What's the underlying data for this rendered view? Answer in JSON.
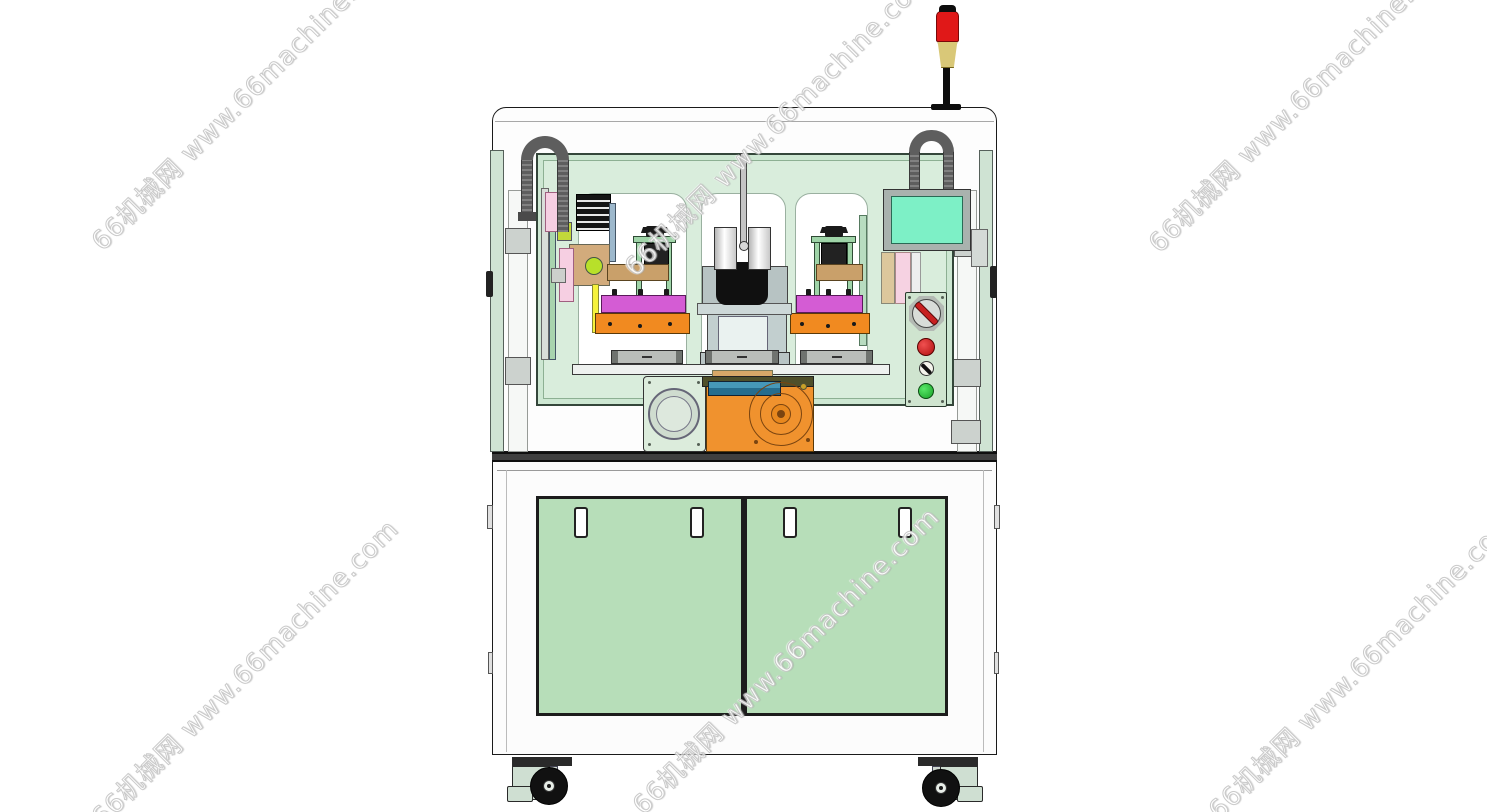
{
  "page": {
    "type": "product-image",
    "description": "CAD front view of a dual-station automatic assembly / screw-locking machine with safety enclosure, monitor, control panel, rotary indexer and caster base",
    "background_color": "#ffffff"
  },
  "watermark": {
    "text": "66机械网 www.66machine.com",
    "repeat_count": 6,
    "rotation_deg": -45,
    "text_color": "#ffffff",
    "outline_color": "#c6c6c6"
  },
  "machine": {
    "components": [
      "signal-tower",
      "safety-enclosure-window",
      "cable-drag-chain-left",
      "cable-drag-chain-right",
      "touch-monitor",
      "control-panel",
      "rotary-switch",
      "emergency-stop-button",
      "key-switch",
      "start-button",
      "left-fixture-station",
      "right-fixture-station",
      "center-press-unit",
      "motor-plate",
      "rotary-indexer-gearbox",
      "cabinet-door-left",
      "cabinet-door-right",
      "door-handles",
      "leveling-caster-left",
      "leveling-caster-right"
    ],
    "colors": {
      "enclosure_white": "#fcfcfc",
      "glass_green": "#cde7d2",
      "panel_green": "#d9eddc",
      "door_green": "#b7deb9",
      "control_panel_green": "#cfe4cf",
      "screen_mint": "#7df0c6",
      "base_orange": "#f0922e",
      "fixture_magenta": "#d45cd4",
      "clamp_tan": "#c9a06a",
      "plate_pink": "#f6d2e2",
      "accent_yellow_green": "#b8e02a",
      "signal_red": "#e01818",
      "signal_yellow": "#d9c878",
      "gearbox_blue": "#2e7d9e",
      "estop_red": "#c82020",
      "start_green": "#22c23a",
      "chain_gray": "#5e5e5e"
    }
  }
}
